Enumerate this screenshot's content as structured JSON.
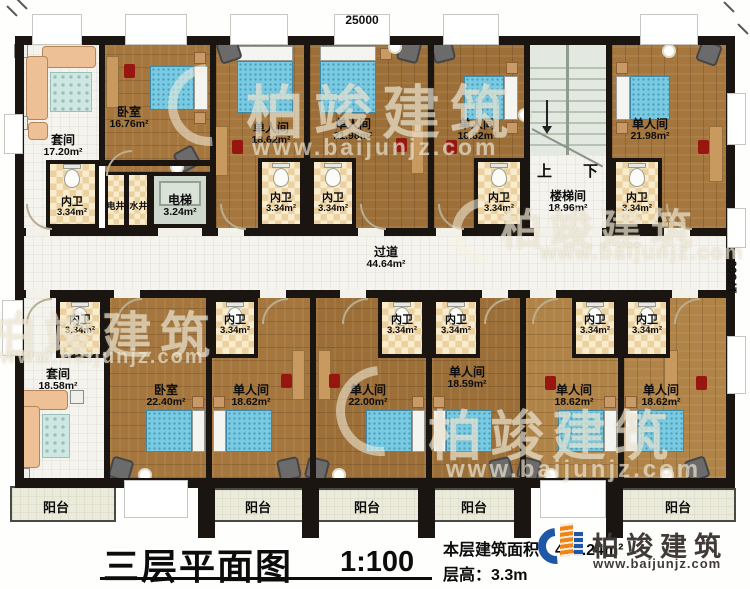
{
  "plan": {
    "dim_top": "25000",
    "dim_right": "17500",
    "corridor": {
      "name": "过道",
      "area": "44.64m²"
    },
    "stairwell": {
      "name": "楼梯间",
      "area": "18.96m²",
      "up": "上",
      "down": "下"
    },
    "elevator": {
      "name": "电梯",
      "area": "3.24m²"
    },
    "shafts": [
      {
        "name": "电井"
      },
      {
        "name": "水井"
      }
    ],
    "top_rooms": [
      {
        "name": "套间",
        "area": "17.20m²"
      },
      {
        "name": "卧室",
        "area": "16.76m²"
      },
      {
        "name": "单人间",
        "area": "18.62m²"
      },
      {
        "name": "单人间",
        "area": "21.98m²"
      },
      {
        "name": "单人间",
        "area": "18.62m²"
      },
      {
        "name": "单人间",
        "area": "21.98m²"
      }
    ],
    "top_baths": [
      {
        "name": "内卫",
        "area": "3.34m²"
      },
      {
        "name": "内卫",
        "area": "3.34m²"
      },
      {
        "name": "内卫",
        "area": "3.34m²"
      },
      {
        "name": "内卫",
        "area": "3.34m²"
      },
      {
        "name": "内卫",
        "area": "3.34m²"
      }
    ],
    "bottom_rooms": [
      {
        "name": "套间",
        "area": "18.58m²"
      },
      {
        "name": "卧室",
        "area": "22.40m²"
      },
      {
        "name": "单人间",
        "area": "18.62m²"
      },
      {
        "name": "单人间",
        "area": "22.00m²"
      },
      {
        "name": "单人间",
        "area": "18.59m²"
      },
      {
        "name": "单人间",
        "area": "18.62m²"
      },
      {
        "name": "单人间",
        "area": "18.62m²"
      }
    ],
    "bottom_baths": [
      {
        "name": "内卫",
        "area": "3.34m²"
      },
      {
        "name": "内卫",
        "area": "3.34m²"
      },
      {
        "name": "内卫",
        "area": "3.34m²"
      },
      {
        "name": "内卫",
        "area": "3.34m²"
      },
      {
        "name": "内卫",
        "area": "3.34m²"
      },
      {
        "name": "内卫",
        "area": "3.34m²"
      }
    ],
    "balconies": [
      "阳台",
      "阳台",
      "阳台",
      "阳台",
      "阳台"
    ]
  },
  "title_block": {
    "title": "三层平面图",
    "scale": "1:100",
    "area_label": "本层建筑面积：",
    "area_value": "408.24m²",
    "height_label": "层高：",
    "height_value": "3.3m"
  },
  "logo": {
    "name": "柏竣建筑",
    "site": "www.baijunjz.com"
  },
  "watermark": {
    "brand": "柏竣建筑",
    "site": "www.baijunjz.com"
  }
}
